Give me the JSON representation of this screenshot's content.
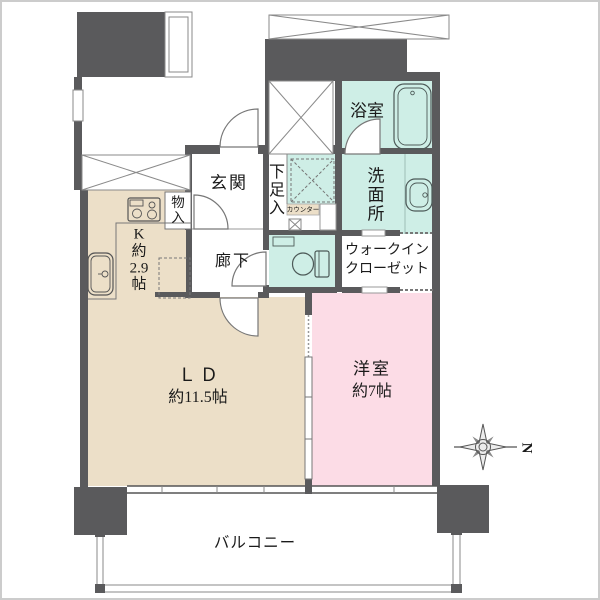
{
  "plan_title": "apartment-floor-plan",
  "colors": {
    "wall": "#5a5a5c",
    "room_ld_kitchen": "#ecdfc8",
    "room_western": "#fcdce6",
    "room_wet": "#ceeee6",
    "line": "#666666"
  },
  "rooms": {
    "bathroom": {
      "label": "浴室"
    },
    "washroom": {
      "label_lines": [
        "洗",
        "面",
        "所"
      ]
    },
    "shoe_storage": {
      "label_lines": [
        "下",
        "足",
        "入"
      ]
    },
    "entrance": {
      "label": "玄関"
    },
    "storage": {
      "label_lines": [
        "物",
        "入"
      ]
    },
    "counter": {
      "label": "カウンター"
    },
    "hallway": {
      "label": "廊下"
    },
    "walk_in_closet": {
      "label_lines": [
        "ウォークイン",
        "クローゼット"
      ]
    },
    "kitchen": {
      "label_lines": [
        "K",
        "約",
        "2.9",
        "帖"
      ]
    },
    "living_dining": {
      "label": "ＬＤ",
      "size": "約11.5帖"
    },
    "western_room": {
      "label": "洋室",
      "size": "約7帖"
    },
    "balcony": {
      "label": "バルコニー"
    }
  },
  "compass": {
    "north_label": "N"
  }
}
